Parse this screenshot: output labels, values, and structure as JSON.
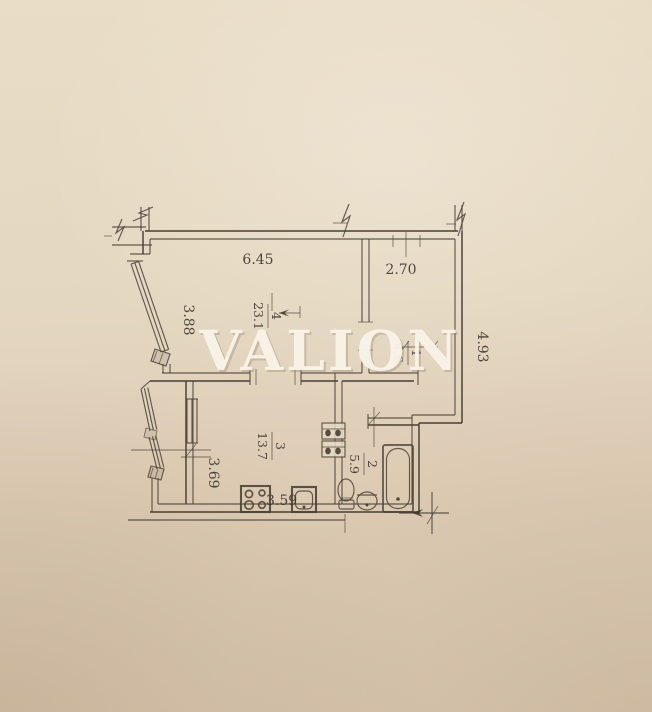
{
  "watermark": {
    "text": "VALION",
    "color": "#faf5ea",
    "shadow_color": "#9e8d74"
  },
  "paper": {
    "top": "#e9ddc7",
    "bottom": "#d7c4ac",
    "line": "#4b4237"
  },
  "plan": {
    "type": "apartment-floor-plan",
    "rooms": [
      {
        "number": "4",
        "area": "23.1",
        "label": "living-room"
      },
      {
        "number": "1",
        "area": "4.6",
        "label": "hallway"
      },
      {
        "number": "3",
        "area": "13.7",
        "label": "kitchen"
      },
      {
        "number": "2",
        "area": "5.9",
        "label": "bathroom"
      }
    ],
    "dimensions": {
      "top_wall": "6.45",
      "hall_top": "2.70",
      "left_window": "3.88",
      "right_wall": "4.93",
      "kitchen_side": "3.69",
      "kitchen_bottom": "3.59"
    },
    "fixtures": [
      "stove",
      "kitchen-sink",
      "toilet",
      "washbasin",
      "bathtub",
      "vent-shaft",
      "window",
      "balcony-glazing"
    ]
  }
}
